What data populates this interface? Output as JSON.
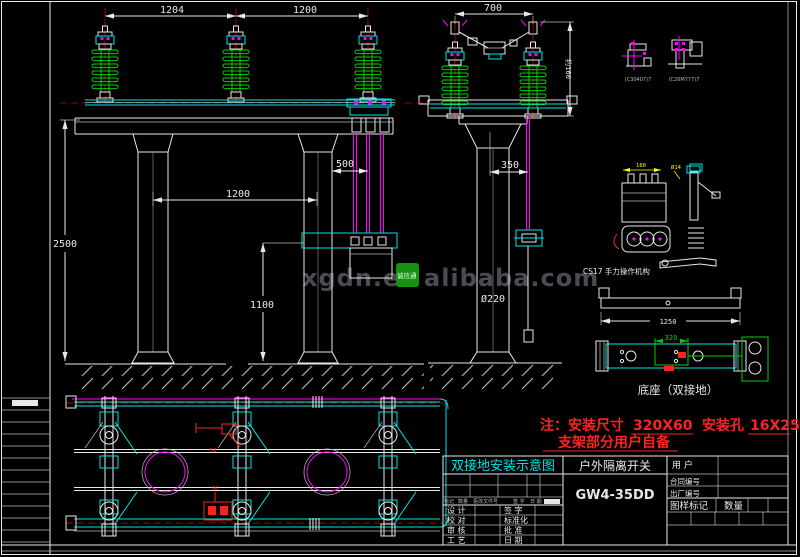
{
  "sheet": {
    "watermark_prefix": "xgdn.en",
    "watermark_badge": "诚信通",
    "watermark_suffix": "alibaba.com"
  },
  "front_view": {
    "dim_1204": "1204",
    "dim_1200_top": "1200",
    "dim_2500": "2500",
    "dim_1200_mid": "1200",
    "dim_1100": "1100",
    "dim_500": "500"
  },
  "side_view": {
    "dim_700": "700",
    "dim_160": "约160",
    "dim_350": "350",
    "dim_col": "Ø220"
  },
  "details": {
    "tag_left": "(C30407)7",
    "tag_right": "(C26M777)7",
    "dim_160": "160",
    "dim_d14": "Ø14",
    "mech_label": "CS17 手力操作机构",
    "dim_1250": "1250",
    "dim_320": "320",
    "base_label": "底座（双接地）",
    "plan_tag_top": "50",
    "plan_tag_bottom": "50"
  },
  "note": {
    "prefix": "注：安装尺寸",
    "dim1": "320X60",
    "mid": "安装孔",
    "dim2": "16X25",
    "line2": "支架部分用户自备"
  },
  "title_block": {
    "drawing_title": "双接地安装示意图",
    "product_name": "户外隔离开关",
    "model": "GW4-35DD",
    "customer_label": "用  户",
    "contract_label": "合同编号",
    "factory_label": "出厂编号",
    "mark_label": "图样标记",
    "qty_label": "数量",
    "rev_header": {
      "mark": "标记",
      "qty": "数量",
      "doc": "更改文件号",
      "sign": "签 字",
      "date": "日 期"
    },
    "sign_rows": [
      {
        "left": "设 计",
        "right": "签 字"
      },
      {
        "left": "校 对",
        "right": "标准化"
      },
      {
        "left": "审 核",
        "right": "批 准"
      },
      {
        "left": "工 艺",
        "right": "日 期"
      }
    ]
  }
}
